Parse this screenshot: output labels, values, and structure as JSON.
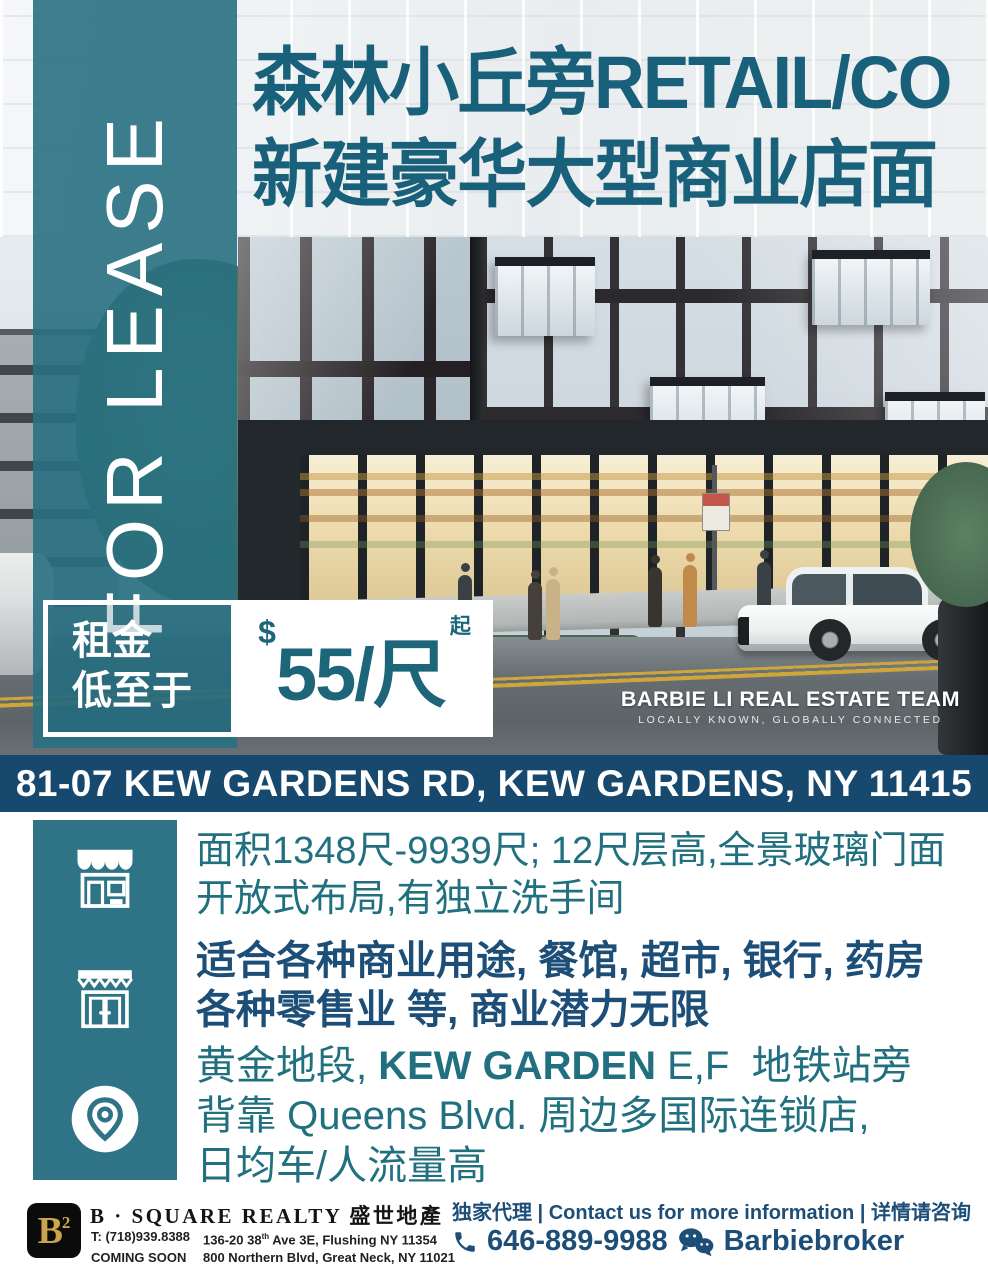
{
  "colors": {
    "banner_teal": "#2e7486",
    "navy_bar": "#16496d",
    "navy_text": "#1d4e78",
    "title_teal": "#19607a",
    "feature_teal": "#21707f",
    "price_teal": "#1d6579",
    "gold": "#c9a54c"
  },
  "banner": {
    "label": "FOR LEASE"
  },
  "title": {
    "line1": "森林小丘旁RETAIL/CO",
    "line2": "新建豪华大型商业店面"
  },
  "price": {
    "label1": "租金",
    "label2": "低至于",
    "currency": "$",
    "value": "55/尺",
    "suffix": "起"
  },
  "team": {
    "name": "BARBIE LI REAL ESTATE TEAM",
    "tagline": "LOCALLY KNOWN, GLOBALLY CONNECTED"
  },
  "address_bar": {
    "text": "81-07 KEW GARDENS RD, KEW GARDENS, NY 11415"
  },
  "features": {
    "row1": {
      "icon": "storefront-awning-icon",
      "line1": "面积1348尺-9939尺; 12尺层高,全景玻璃门面",
      "line2": "开放式布局,有独立洗手间"
    },
    "row2": {
      "icon": "shop-front-icon",
      "line1": "适合各种商业用途, 餐馆, 超市, 银行, 药房",
      "line2": "各种零售业 等, 商业潜力无限"
    },
    "row3": {
      "icon": "location-pin-icon",
      "line1_pre": "黄金地段, ",
      "line1_bold": "KEW GARDEN",
      "line1_post": " E,F  地铁站旁",
      "line2": "背靠 Queens Blvd. 周边多国际连锁店,",
      "line3": "日均车/人流量高"
    }
  },
  "footer": {
    "logo": {
      "letter": "B",
      "exponent": "2"
    },
    "company": "B · SQUARE REALTY 盛世地產",
    "row1_col1": "T: (718)939.8388",
    "row1_col2_pre": "136-20 38",
    "row1_col2_sup": "th",
    "row1_col2_post": " Ave 3E, Flushing NY 11354",
    "row2_col1": "COMING SOON",
    "row2_col2": "800 Northern Blvd, Great Neck, NY 11021",
    "contact_line": "独家代理 | Contact us for more information | 详情请咨询",
    "phone": "646-889-9988",
    "wechat": "Barbiebroker"
  }
}
